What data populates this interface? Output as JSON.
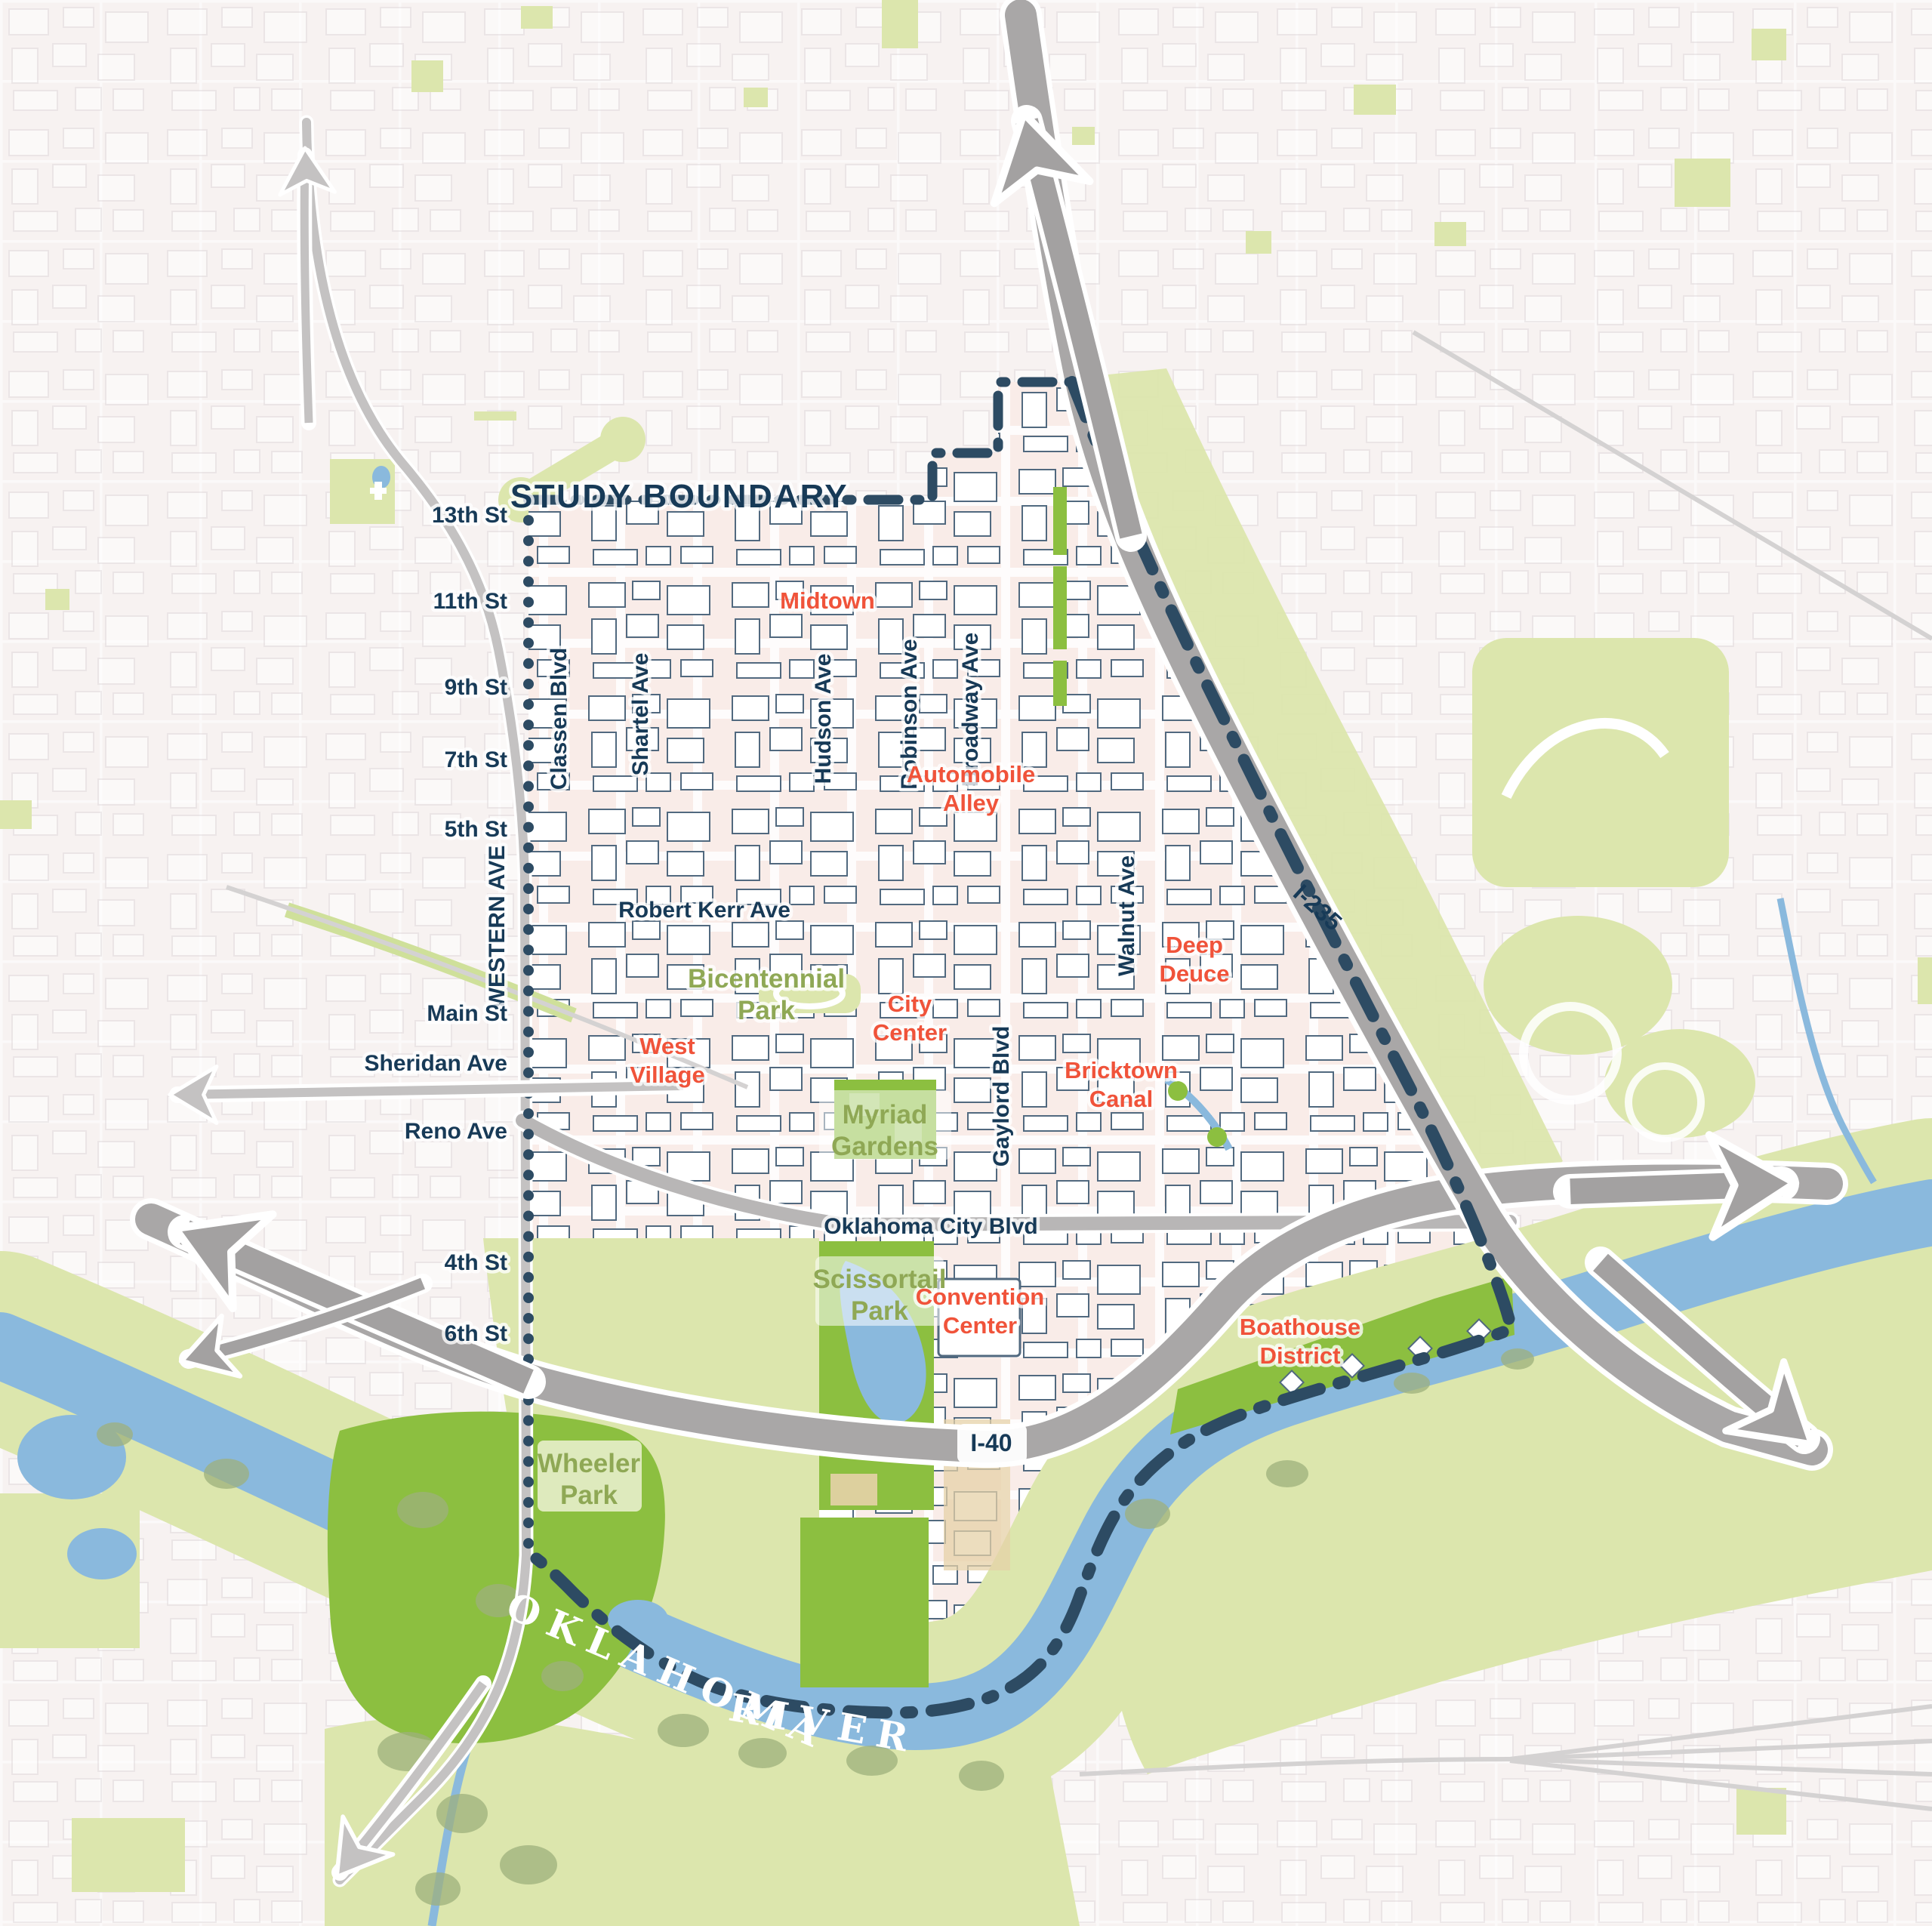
{
  "colors": {
    "study_boundary_navy": "#2d4b63",
    "label_navy": "#173a57",
    "district_orange": "#f0533a",
    "park_label_green": "#8fa855",
    "park_bright_green": "#8cbf40",
    "park_light_green": "#dce6ad",
    "river_blue": "#8ab9dd",
    "highway_gray": "#a9a7a7",
    "arrow_gray": "#a3a1a1",
    "study_area_fill": "#f9ece8",
    "outer_bg": "#f7f2f1",
    "building_stroke": "#51697f"
  },
  "title": {
    "study_boundary": "STUDY BOUNDARY"
  },
  "labels": {
    "streets": {
      "s13": "13th St",
      "s11": "11th St",
      "s9": "9th St",
      "s7": "7th St",
      "s5": "5th St",
      "s4": "4th St",
      "s6": "6th St",
      "western": "WESTERN AVE",
      "main": "Main St",
      "sheridan": "Sheridan Ave",
      "reno": "Reno Ave",
      "classen": "Classen Blvd",
      "shartel": "Shartel Ave",
      "hudson": "Hudson Ave",
      "robinson": "Robinson Ave",
      "broadway": "Broadway Ave",
      "walnut": "Walnut Ave",
      "gaylord": "Gaylord Blvd",
      "robert_kerr": "Robert Kerr Ave",
      "okc_blvd": "Oklahoma City Blvd"
    },
    "highways": {
      "i40": "I-40",
      "i235": "I-235"
    },
    "districts": {
      "midtown": "Midtown",
      "automobile_alley": {
        "l1": "Automobile",
        "l2": "Alley"
      },
      "deep_deuce": {
        "l1": "Deep",
        "l2": "Deuce"
      },
      "city_center": {
        "l1": "City",
        "l2": "Center"
      },
      "west_village": {
        "l1": "West",
        "l2": "Village"
      },
      "bricktown_canal": {
        "l1": "Bricktown",
        "l2": "Canal"
      },
      "convention_center": {
        "l1": "Convention",
        "l2": "Center"
      },
      "boathouse_district": {
        "l1": "Boathouse",
        "l2": "District"
      }
    },
    "parks": {
      "bicentennial": {
        "l1": "Bicentennial",
        "l2": "Park"
      },
      "myriad": {
        "l1": "Myriad",
        "l2": "Gardens"
      },
      "scissortail": {
        "l1": "Scissortail",
        "l2": "Park"
      },
      "wheeler": {
        "l1": "Wheeler",
        "l2": "Park"
      }
    },
    "water": {
      "river_l1": "OKLAHOMA",
      "river_l2": "RIVER"
    }
  }
}
